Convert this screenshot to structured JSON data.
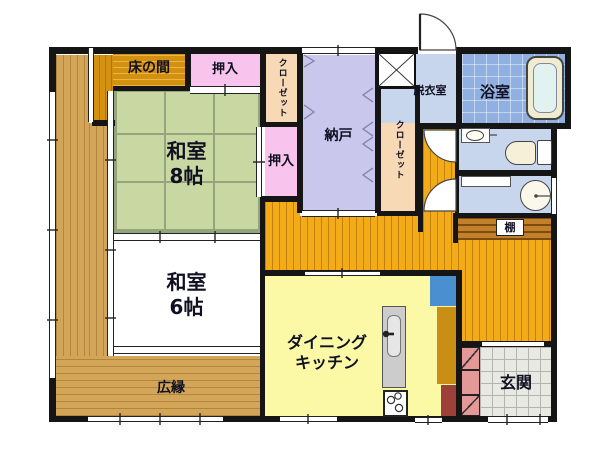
{
  "rooms": {
    "tokonoma": {
      "label": "床の間"
    },
    "oshiire_top": {
      "label": "押入"
    },
    "closet_west": {
      "label": "クローゼット"
    },
    "washitsu8": {
      "name": "和室",
      "size": "8帖"
    },
    "oshiire_east": {
      "label": "押入"
    },
    "nando": {
      "label": "納戸"
    },
    "closet_center": {
      "label": "クローゼット"
    },
    "datsuishitsu": {
      "label": "脱衣室"
    },
    "yokushitsu": {
      "label": "浴室"
    },
    "washitsu6": {
      "name": "和室",
      "size": "6帖"
    },
    "hiroen": {
      "label": "広縁"
    },
    "dining_kitchen": {
      "line1": "ダイニング",
      "line2": "キッチン"
    },
    "genkan": {
      "label": "玄関"
    },
    "tana": {
      "label": "棚"
    }
  },
  "fixtures": {
    "washing_machine_pan": "x-box",
    "bathtub": "bathtub",
    "toilet": "toilet",
    "hand_sink": "small-oval-sink",
    "washbasin": "round-basin",
    "kitchen_sink": "counter-sink",
    "stove": "3-burner-stove",
    "refrigerator": "blue-box",
    "tall_cabinet": "mustard-box",
    "storage_red": "dark-red-box",
    "shoe_cabinet": "hatched-pink-boxes",
    "doors": [
      "back-door-swing",
      "toilet-door-swing",
      "washbasin-door-swing",
      "sliding-doors",
      "folding-closet-marks"
    ]
  },
  "colors": {
    "wall": "#151515",
    "tatami": "#c9d8a3",
    "tatami_line": "#93a57d",
    "wood_veranda": "#d3a558",
    "wood_tokonoma": "#d49110",
    "closet_pink": "#f8c4ee",
    "closet_peach": "#f7d9b6",
    "storage_lavender": "#c9c7ec",
    "wet_blue": "#c7d6ec",
    "bath_tile": "#8fb0e0",
    "corridor_orange": "#f3ac17",
    "kitchen_yellow": "#fbf8a6",
    "genkan_gray": "#e9e9e4",
    "shelf_brown": "#c1802a",
    "fridge_blue": "#4a8fd0",
    "cabinet_mustard": "#c98f14",
    "cabinet_red": "#9c4038",
    "shoe_pink": "#e59898"
  }
}
